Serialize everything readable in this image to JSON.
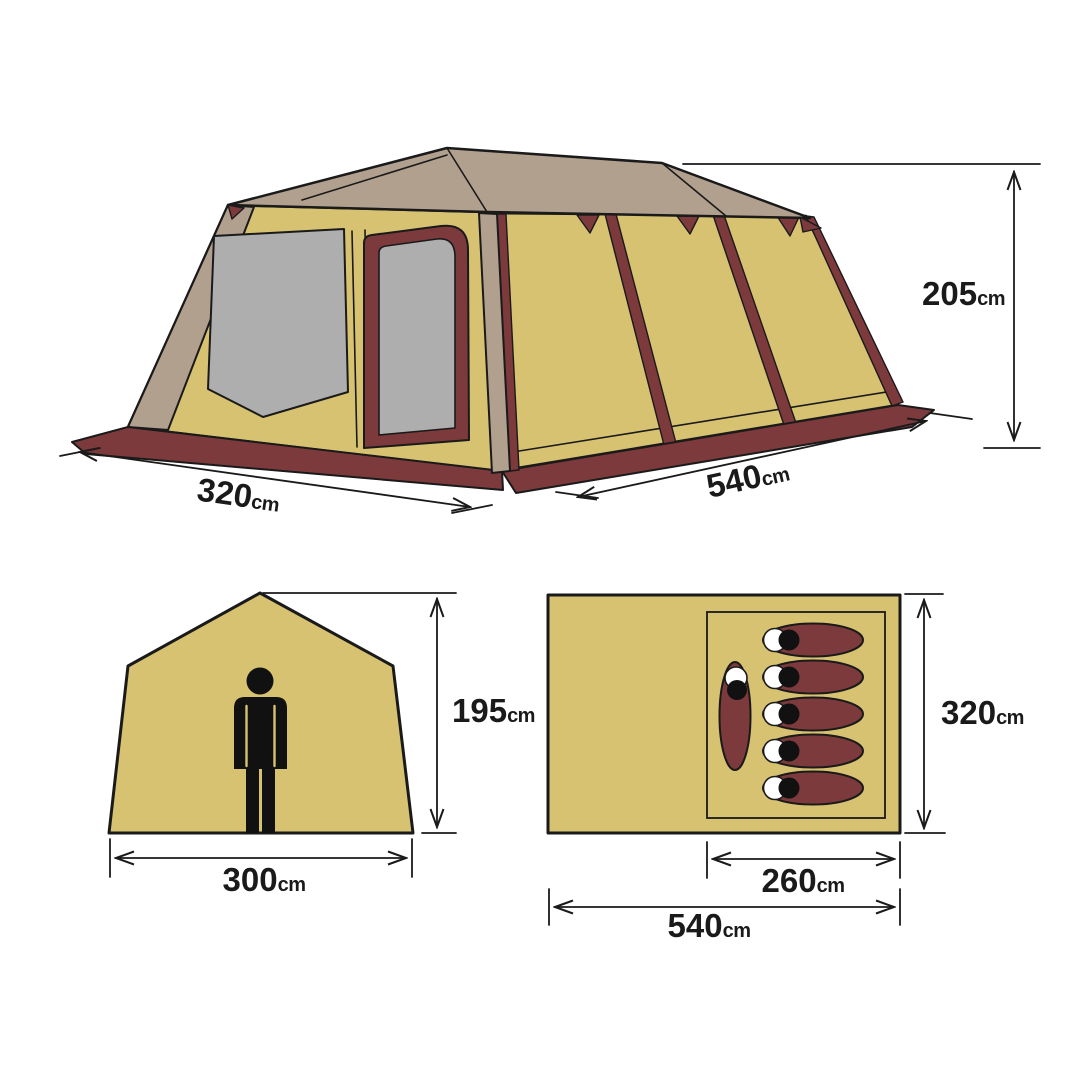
{
  "colors": {
    "paper": "#ffffff",
    "wall": "#d7c272",
    "roof": "#b2a08e",
    "trim": "#7c3a3d",
    "mesh": "#aeaeae",
    "line": "#1a1a1a",
    "figure": "#111111",
    "bag_white": "#ffffff"
  },
  "views": {
    "perspective": {
      "title": "tent exterior perspective view",
      "dims": {
        "depth": {
          "value": "320",
          "unit": "cm"
        },
        "width": {
          "value": "540",
          "unit": "cm"
        },
        "height": {
          "value": "205",
          "unit": "cm"
        }
      }
    },
    "front": {
      "title": "tent front elevation with person",
      "dims": {
        "height": {
          "value": "195",
          "unit": "cm"
        },
        "width": {
          "value": "300",
          "unit": "cm"
        }
      }
    },
    "floor": {
      "title": "tent floor plan",
      "dims": {
        "depth": {
          "value": "320",
          "unit": "cm"
        },
        "inner_width": {
          "value": "260",
          "unit": "cm"
        },
        "width": {
          "value": "540",
          "unit": "cm"
        }
      },
      "occupants": {
        "sleeping_bags": 5,
        "seated_people": 1
      }
    }
  }
}
